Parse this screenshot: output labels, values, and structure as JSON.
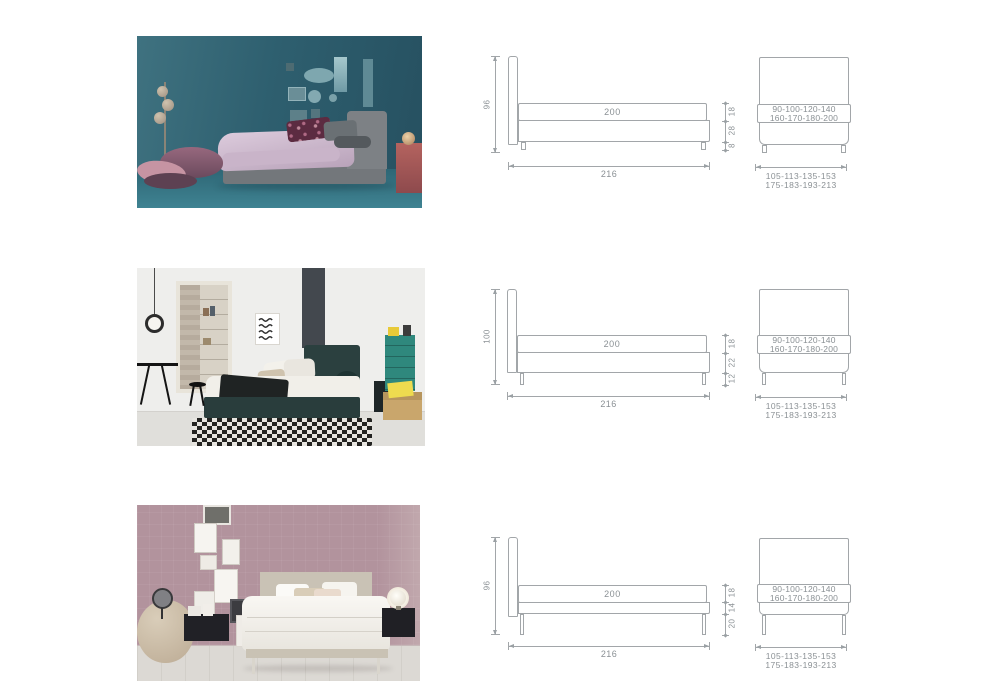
{
  "palette": {
    "page_bg": "#ffffff",
    "drawing_line": "#a2a6a9",
    "dimension_text": "#8a9094"
  },
  "rows": [
    {
      "side_view": {
        "headboard_height": "96",
        "mattress_length": "200",
        "overall_length": "216",
        "thickness_stack": [
          "18",
          "28",
          "8"
        ]
      },
      "front_view": {
        "mattress_widths": [
          "90-100-120-140",
          "160-170-180-200"
        ],
        "overall_widths": [
          "105-113-135-153",
          "175-183-193-213"
        ]
      }
    },
    {
      "side_view": {
        "headboard_height": "100",
        "mattress_length": "200",
        "overall_length": "216",
        "thickness_stack": [
          "18",
          "22",
          "12"
        ]
      },
      "front_view": {
        "mattress_widths": [
          "90-100-120-140",
          "160-170-180-200"
        ],
        "overall_widths": [
          "105-113-135-153",
          "175-183-193-213"
        ]
      }
    },
    {
      "side_view": {
        "headboard_height": "96",
        "mattress_length": "200",
        "overall_length": "216",
        "thickness_stack": [
          "18",
          "14",
          "20"
        ]
      },
      "front_view": {
        "mattress_widths": [
          "90-100-120-140",
          "160-170-180-200"
        ],
        "overall_widths": [
          "105-113-135-153",
          "175-183-193-213"
        ]
      }
    }
  ]
}
